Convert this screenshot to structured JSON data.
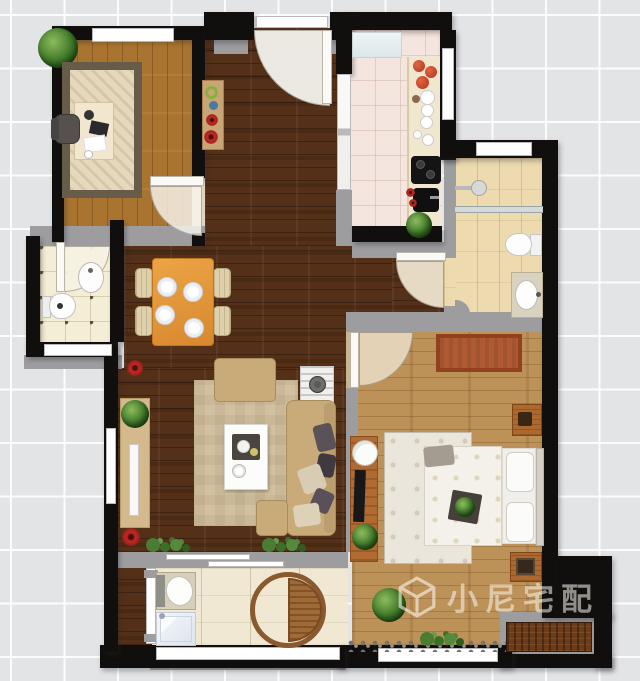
{
  "title": "apartment-floor-plan-top-view",
  "watermark": {
    "text": "小尼宅配",
    "logo": "cube-outline-logo",
    "color": "rgba(250,247,240,0.55)"
  },
  "palette": {
    "background": "#e3e4e6",
    "grid_line": "#ffffff",
    "wall_black": "#100f0d",
    "wall_gray": "#9d9da0",
    "wood_dark_hall_living": "#553018",
    "wood_study": "#a9742f",
    "wood_bedroom": "#bd9258",
    "tile_kitchen": "#f4e6df",
    "tile_bath_main": "#eddaaf",
    "tile_bath_small": "#f5eed6",
    "tile_balcony": "#f0e8d3",
    "sofa_beige": "#c9ab7a",
    "dining_table_orange": "#e0933a",
    "bedroom_red_rug": "#b05a33",
    "accent_red": "#b3252b",
    "plant_green": "#3c7526",
    "window_white": "#ffffff"
  },
  "rooms": [
    {
      "name": "study",
      "floor": "light wood planks",
      "furniture": [
        "corner potted plant",
        "window bench",
        "patterned area rug",
        "desk with laptop, papers, cup",
        "office chair"
      ]
    },
    {
      "name": "entry-hall",
      "floor": "dark wood planks",
      "furniture": [
        "entrance door with swing",
        "console table with decor items"
      ]
    },
    {
      "name": "kitchen",
      "floor": "pink tile",
      "furniture": [
        "fridge",
        "counter run",
        "tomatoes",
        "stacked plates",
        "black cooktop",
        "black sink",
        "red flowers",
        "potted plant",
        "sliding door to hall"
      ]
    },
    {
      "name": "bathroom-main",
      "floor": "beige tile",
      "furniture": [
        "shower head",
        "glass screen",
        "toilet",
        "vanity with oval sink"
      ]
    },
    {
      "name": "bathroom-small",
      "floor": "cream tile with dots",
      "furniture": [
        "toilet",
        "oval pedestal sink"
      ]
    },
    {
      "name": "dining-area",
      "floor": "dark wood planks",
      "furniture": [
        "orange dining table",
        "4 chairs",
        "4 place settings"
      ]
    },
    {
      "name": "living-room",
      "floor": "dark wood planks",
      "furniture": [
        "TV console with plant and TV",
        "beige area rug",
        "ottoman armchair",
        "white coffee table with tray",
        "L-shaped beige sofa with pillows",
        "striped side table with lamp",
        "red flower decor x2",
        "window shrubs x2"
      ]
    },
    {
      "name": "bedroom",
      "floor": "tan wood planks",
      "furniture": [
        "red rug",
        "dresser with TV and plant",
        "white side table",
        "cream bed rug",
        "double bed with floral blanket",
        "2 pillows",
        "headboard",
        "nightstand top",
        "nightstand bottom",
        "plant tray on bed",
        "large plant",
        "window stones and shrubs"
      ]
    },
    {
      "name": "balcony",
      "floor": "cream tile",
      "furniture": [
        "laundry sink unit",
        "washing machine",
        "round rattan chair"
      ]
    },
    {
      "name": "exterior-platform",
      "floor": "concrete gray",
      "furniture": [
        "outdoor AC cabinet"
      ]
    }
  ],
  "doors": [
    "entrance-door",
    "study-door",
    "small-bathroom-door",
    "main-bathroom-door",
    "bedroom-door",
    "kitchen-sliding-door",
    "balcony-sliding-window",
    "balcony-glass-door"
  ],
  "windows": [
    "study-top-window",
    "kitchen-right-window",
    "main-bathroom-top-window",
    "small-bathroom-bottom-window",
    "living-left-window",
    "balcony-bottom-window",
    "bedroom-bottom-window"
  ]
}
